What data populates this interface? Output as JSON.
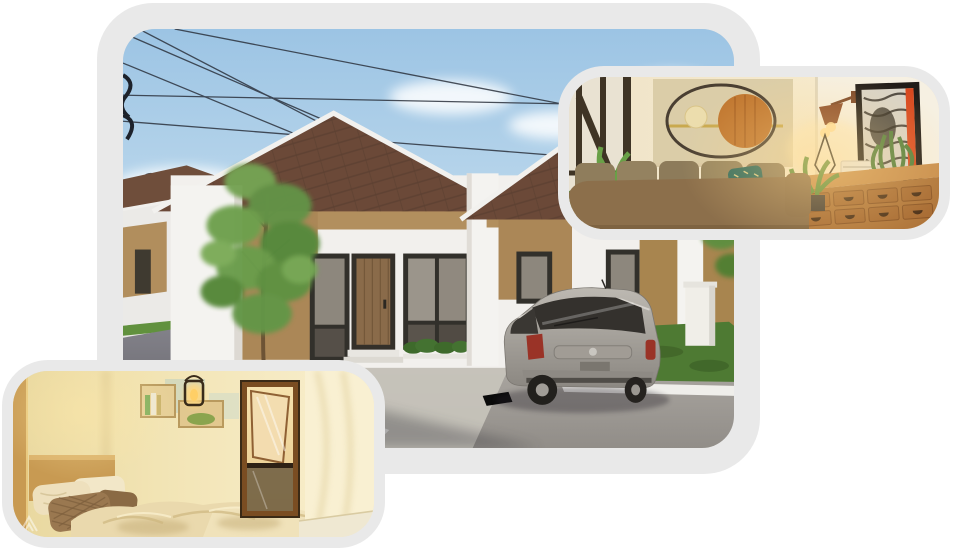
{
  "page": {
    "background": "#ffffff",
    "canvas_width": 953,
    "canvas_height": 551
  },
  "collage": {
    "frame_color": "#e9e9e9",
    "photos": [
      {
        "id": "house-exterior",
        "label": "Exterior render of a minimalist one-story house with brown gable roofs, tan accent walls, a tree, gravel driveway and a parked silver MPV under a blue sky with power lines",
        "palette": {
          "sky": "#9cc4e4",
          "roof": "#6b4938",
          "accent_wall": "#b28f5e",
          "white_wall": "#f2f0ed",
          "driveway": "#a8a49e",
          "road": "#5e5d62",
          "grass": "#4e7a33",
          "tree": "#639347",
          "car": "#9a948c",
          "door_wood": "#8a6b4a"
        }
      },
      {
        "id": "living-room",
        "label": "Warmly lit living room with taupe sofa, teal accent cushion, beige wall-art panel with ring and wooden disc, wall lamp, framed artwork with red accent, plants and wooden drawer console",
        "palette": {
          "wall": "#f3e8cf",
          "art_panel": "#dbcda8",
          "sofa": "#8c6f4b",
          "accent_cushion": "#2e6a5d",
          "console_wood": "#b0763b",
          "art_red_accent": "#d8481f",
          "lamp_shade": "#8a4a28",
          "plant": "#5e8f3e"
        }
      },
      {
        "id": "bedroom",
        "label": "Warm cream bedroom with wooden headboard, cream and brown pillows, crumpled duvet, wall shelves with books and a glowing lantern, and a dark framed mirror door",
        "palette": {
          "wall": "#f2e4b4",
          "wood": "#c89a52",
          "blanket": "#ead9ad",
          "pillow_brown": "#9a7850",
          "mirror_frame": "#7a4d22",
          "lantern_glow": "#ffd77e"
        },
        "watermark_icon": "mountain-chevron"
      }
    ]
  }
}
